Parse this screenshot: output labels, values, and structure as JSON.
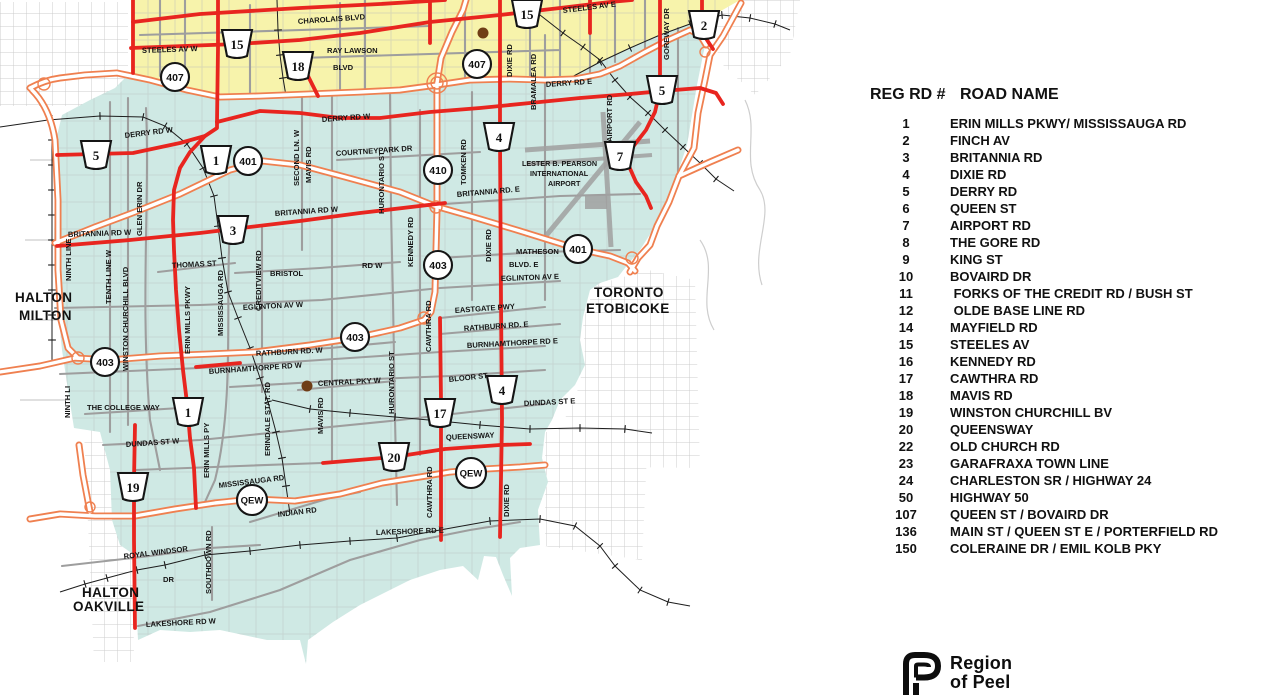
{
  "map": {
    "colors": {
      "brampton_fill": "#f7f3ab",
      "mississauga_fill": "#cfe9e4",
      "regional_road_red": "#e8251f",
      "highway_orange": "#ef8050",
      "minor_road_gray": "#bdbdbd",
      "railway_black": "#1d1d1d",
      "landmark_dot_brown": "#6f3d16"
    },
    "road_labels": [
      {
        "text": "CHAROLAIS BLVD",
        "x": 298,
        "y": 24,
        "r": -4
      },
      {
        "text": "STEELES AV W",
        "x": 142,
        "y": 53,
        "r": -2
      },
      {
        "text": "STEELES AV E",
        "x": 563,
        "y": 13,
        "r": -7
      },
      {
        "text": "RAY LAWSON",
        "x": 327,
        "y": 53,
        "r": 0
      },
      {
        "text": "BLVD",
        "x": 333,
        "y": 70,
        "r": 0
      },
      {
        "text": "DIXIE RD",
        "x": 512,
        "y": 77,
        "r": -90
      },
      {
        "text": "BRAMALEA RD",
        "x": 536,
        "y": 110,
        "r": -90
      },
      {
        "text": "GOREWAY DR",
        "x": 669,
        "y": 60,
        "r": -90
      },
      {
        "text": "AIRPORT RD",
        "x": 612,
        "y": 142,
        "r": -90
      },
      {
        "text": "DERRY RD E",
        "x": 546,
        "y": 87,
        "r": -4
      },
      {
        "text": "DERRY RD W",
        "x": 322,
        "y": 122,
        "r": -4
      },
      {
        "text": "DERRY RD W",
        "x": 125,
        "y": 138,
        "r": -7
      },
      {
        "text": "SECOND LN. W",
        "x": 299,
        "y": 186,
        "r": -90
      },
      {
        "text": "MAVIS RD",
        "x": 311,
        "y": 183,
        "r": -90
      },
      {
        "text": "COURTNEYPARK DR",
        "x": 336,
        "y": 156,
        "r": -4
      },
      {
        "text": "GLEN ERIN DR",
        "x": 142,
        "y": 236,
        "r": -90
      },
      {
        "text": "HURONTARIO ST",
        "x": 384,
        "y": 214,
        "r": -90
      },
      {
        "text": "TOMKEN RD",
        "x": 466,
        "y": 185,
        "r": -90
      },
      {
        "text": "BRITANNIA RD. E",
        "x": 457,
        "y": 197,
        "r": -5
      },
      {
        "text": "MATHESON",
        "x": 516,
        "y": 254,
        "r": 0
      },
      {
        "text": "BLVD.  E",
        "x": 509,
        "y": 267,
        "r": 0
      },
      {
        "text": "EGLINTON AV E",
        "x": 501,
        "y": 281,
        "r": -2
      },
      {
        "text": "DIXIE RD",
        "x": 491,
        "y": 262,
        "r": -90
      },
      {
        "text": "KENNEDY RD",
        "x": 413,
        "y": 267,
        "r": -90
      },
      {
        "text": "EASTGATE PWY",
        "x": 455,
        "y": 313,
        "r": -4
      },
      {
        "text": "RATHBURN RD. E",
        "x": 464,
        "y": 331,
        "r": -4
      },
      {
        "text": "BURNHAMTHORPE RD E",
        "x": 467,
        "y": 348,
        "r": -3
      },
      {
        "text": "BLOOR ST",
        "x": 449,
        "y": 382,
        "r": -6
      },
      {
        "text": "DUNDAS ST E",
        "x": 524,
        "y": 406,
        "r": -3
      },
      {
        "text": "QUEENSWAY",
        "x": 446,
        "y": 440,
        "r": -3
      },
      {
        "text": "CAWTHRA RD",
        "x": 431,
        "y": 352,
        "r": -90
      },
      {
        "text": "CAWTHRA RD",
        "x": 432,
        "y": 518,
        "r": -90
      },
      {
        "text": "DIXIE RD",
        "x": 509,
        "y": 517,
        "r": -90
      },
      {
        "text": "HURONTARIO ST",
        "x": 394,
        "y": 414,
        "r": -90
      },
      {
        "text": "BRITANNIA  RD  W",
        "x": 68,
        "y": 237,
        "r": -2
      },
      {
        "text": "BRITANNIA RD W",
        "x": 275,
        "y": 216,
        "r": -4
      },
      {
        "text": "THOMAS ST",
        "x": 172,
        "y": 268,
        "r": -3
      },
      {
        "text": "BRISTOL",
        "x": 270,
        "y": 276,
        "r": 0
      },
      {
        "text": "RD W",
        "x": 362,
        "y": 268,
        "r": 0
      },
      {
        "text": "EGLINTON  AV  W",
        "x": 243,
        "y": 310,
        "r": -3
      },
      {
        "text": "CREDITVIEW RD",
        "x": 261,
        "y": 311,
        "r": -90
      },
      {
        "text": "MISSISSAUGA RD",
        "x": 223,
        "y": 336,
        "r": -90
      },
      {
        "text": "TENTH LINE W",
        "x": 111,
        "y": 304,
        "r": -90
      },
      {
        "text": "NINTH LINE",
        "x": 71,
        "y": 281,
        "r": -90
      },
      {
        "text": "WINSTON CHURCHILL BLVD",
        "x": 128,
        "y": 371,
        "r": -90
      },
      {
        "text": "ERIN MILLS PKWY",
        "x": 190,
        "y": 354,
        "r": -90
      },
      {
        "text": "RATHBURN RD. W",
        "x": 256,
        "y": 356,
        "r": -3
      },
      {
        "text": "BURNHAMTHORPE RD W",
        "x": 209,
        "y": 374,
        "r": -4
      },
      {
        "text": "CENTRAL PKY W",
        "x": 318,
        "y": 386,
        "r": -3
      },
      {
        "text": "MAVIS RD",
        "x": 323,
        "y": 434,
        "r": -90
      },
      {
        "text": "ERINDALE STAT. RD",
        "x": 270,
        "y": 456,
        "r": -90
      },
      {
        "text": "THE COLLEGE WAY",
        "x": 87,
        "y": 410,
        "r": 0
      },
      {
        "text": "DUNDAS ST W",
        "x": 126,
        "y": 447,
        "r": -4
      },
      {
        "text": "ERIN MILLS PY",
        "x": 209,
        "y": 478,
        "r": -90
      },
      {
        "text": "NINTH LI",
        "x": 70,
        "y": 418,
        "r": -90
      },
      {
        "text": "MISSISSAUGA RD",
        "x": 219,
        "y": 488,
        "r": -7
      },
      {
        "text": "INDIAN  RD",
        "x": 278,
        "y": 517,
        "r": -7
      },
      {
        "text": "ROYAL WINDSOR",
        "x": 124,
        "y": 559,
        "r": -7
      },
      {
        "text": "DR",
        "x": 163,
        "y": 582,
        "r": 0
      },
      {
        "text": "SOUTHDOWN RD",
        "x": 211,
        "y": 594,
        "r": -90
      },
      {
        "text": "LAKESHORE RD W",
        "x": 146,
        "y": 627,
        "r": -3
      },
      {
        "text": "LAKESHORE  RD  E",
        "x": 376,
        "y": 535,
        "r": -2
      },
      {
        "text": "LESTER B. PEARSON",
        "x": 522,
        "y": 166,
        "r": 0,
        "cls": "sm"
      },
      {
        "text": "INTERNATIONAL",
        "x": 530,
        "y": 176,
        "r": 0,
        "cls": "sm"
      },
      {
        "text": "AIRPORT",
        "x": 548,
        "y": 186,
        "r": 0,
        "cls": "sm"
      },
      {
        "text": "HALTON",
        "x": 15,
        "y": 302,
        "r": 0,
        "cls": "area"
      },
      {
        "text": "MILTON",
        "x": 19,
        "y": 320,
        "r": 0,
        "cls": "area"
      },
      {
        "text": "TORONTO",
        "x": 594,
        "y": 297,
        "r": 0,
        "cls": "area"
      },
      {
        "text": "ETOBICOKE",
        "x": 586,
        "y": 313,
        "r": 0,
        "cls": "area"
      },
      {
        "text": "HALTON",
        "x": 82,
        "y": 597,
        "r": 0,
        "cls": "area"
      },
      {
        "text": "OAKVILLE",
        "x": 73,
        "y": 611,
        "r": 0,
        "cls": "area"
      }
    ],
    "shields": [
      {
        "type": "trap",
        "label": "15",
        "x": 237,
        "y": 44
      },
      {
        "type": "trap",
        "label": "15",
        "x": 527,
        "y": 14
      },
      {
        "type": "trap",
        "label": "18",
        "x": 298,
        "y": 66
      },
      {
        "type": "trap",
        "label": "2",
        "x": 704,
        "y": 25
      },
      {
        "type": "trap",
        "label": "5",
        "x": 96,
        "y": 155
      },
      {
        "type": "trap",
        "label": "5",
        "x": 662,
        "y": 90
      },
      {
        "type": "trap",
        "label": "1",
        "x": 216,
        "y": 160
      },
      {
        "type": "trap",
        "label": "4",
        "x": 499,
        "y": 137
      },
      {
        "type": "trap",
        "label": "7",
        "x": 620,
        "y": 156
      },
      {
        "type": "trap",
        "label": "3",
        "x": 233,
        "y": 230
      },
      {
        "type": "trap",
        "label": "1",
        "x": 188,
        "y": 412
      },
      {
        "type": "trap",
        "label": "17",
        "x": 440,
        "y": 413
      },
      {
        "type": "trap",
        "label": "4",
        "x": 502,
        "y": 390
      },
      {
        "type": "trap",
        "label": "20",
        "x": 394,
        "y": 457
      },
      {
        "type": "trap",
        "label": "19",
        "x": 133,
        "y": 487
      },
      {
        "type": "circle",
        "label": "407",
        "x": 175,
        "y": 77
      },
      {
        "type": "circle",
        "label": "407",
        "x": 477,
        "y": 64
      },
      {
        "type": "circle",
        "label": "401",
        "x": 248,
        "y": 161
      },
      {
        "type": "circle",
        "label": "410",
        "x": 438,
        "y": 170
      },
      {
        "type": "circle",
        "label": "401",
        "x": 578,
        "y": 249
      },
      {
        "type": "circle",
        "label": "403",
        "x": 438,
        "y": 265
      },
      {
        "type": "circle",
        "label": "403",
        "x": 355,
        "y": 337
      },
      {
        "type": "circle",
        "label": "403",
        "x": 105,
        "y": 362
      },
      {
        "type": "qew",
        "label": "QEW",
        "x": 252,
        "y": 500
      },
      {
        "type": "qew",
        "label": "QEW",
        "x": 471,
        "y": 473
      }
    ]
  },
  "legend": {
    "col_reg": "REG RD #",
    "col_name": "ROAD NAME",
    "rows": [
      {
        "num": "1",
        "name": "ERIN MILLS PKWY/ MISSISSAUGA RD"
      },
      {
        "num": "2",
        "name": "FINCH AV"
      },
      {
        "num": "3",
        "name": "BRITANNIA RD"
      },
      {
        "num": "4",
        "name": "DIXIE RD"
      },
      {
        "num": "5",
        "name": "DERRY RD"
      },
      {
        "num": "6",
        "name": "QUEEN ST"
      },
      {
        "num": "7",
        "name": "AIRPORT RD"
      },
      {
        "num": "8",
        "name": "THE GORE RD"
      },
      {
        "num": "9",
        "name": "KING ST"
      },
      {
        "num": "10",
        "name": "BOVAIRD DR"
      },
      {
        "num": "11",
        "name": " FORKS OF THE CREDIT RD / BUSH ST"
      },
      {
        "num": "12",
        "name": " OLDE BASE LINE RD"
      },
      {
        "num": "14",
        "name": "MAYFIELD RD"
      },
      {
        "num": "15",
        "name": "STEELES AV"
      },
      {
        "num": "16",
        "name": "KENNEDY RD"
      },
      {
        "num": "17",
        "name": "CAWTHRA RD"
      },
      {
        "num": "18",
        "name": "MAVIS RD"
      },
      {
        "num": "19",
        "name": "WINSTON CHURCHILL BV"
      },
      {
        "num": "20",
        "name": "QUEENSWAY"
      },
      {
        "num": "22",
        "name": "OLD CHURCH RD"
      },
      {
        "num": "23",
        "name": "GARAFRAXA TOWN LINE"
      },
      {
        "num": "24",
        "name": "CHARLESTON SR / HIGHWAY 24"
      },
      {
        "num": "50",
        "name": "HIGHWAY 50"
      },
      {
        "num": "107",
        "name": "QUEEN ST  / BOVAIRD DR"
      },
      {
        "num": "136",
        "name": "MAIN ST / QUEEN ST E / PORTERFIELD RD"
      },
      {
        "num": "150",
        "name": "COLERAINE DR / EMIL KOLB PKY"
      }
    ]
  },
  "logo": {
    "line1": "Region",
    "line2": "of Peel"
  }
}
